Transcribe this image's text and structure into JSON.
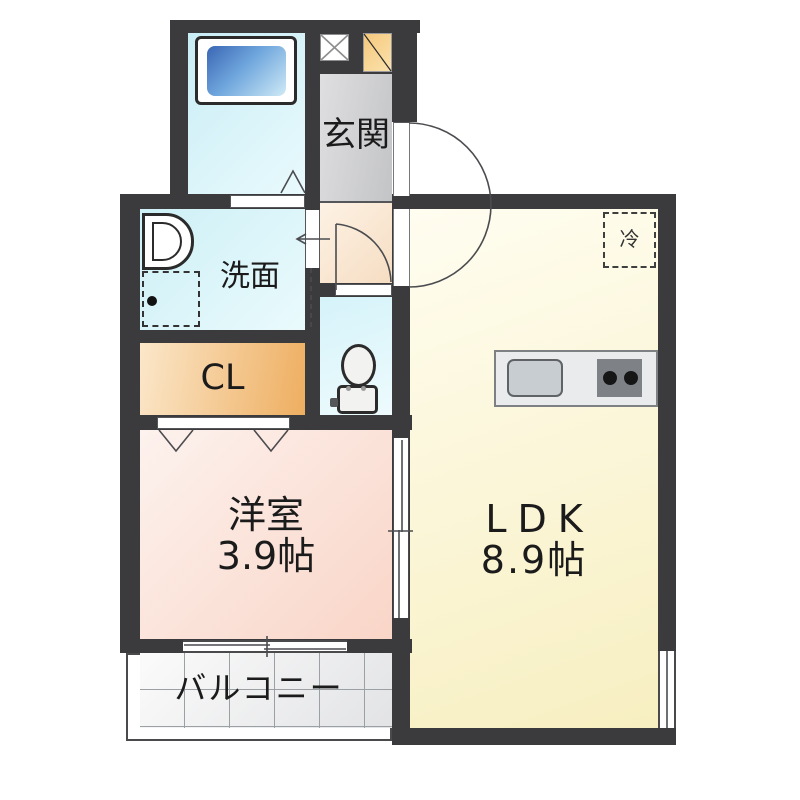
{
  "plan_type": "apartment-floor-plan",
  "rooms": {
    "entrance": {
      "label": "玄関"
    },
    "washroom": {
      "label": "洗面"
    },
    "closet": {
      "label": "CL"
    },
    "western_room": {
      "label": "洋室",
      "size": "3.9帖"
    },
    "ldk": {
      "label": "LDK",
      "size": "8.9帖"
    },
    "balcony": {
      "label": "バルコニー"
    },
    "bathroom": {
      "label": ""
    },
    "toilet": {
      "label": ""
    }
  },
  "fridge": {
    "label": "冷"
  },
  "fixtures": {
    "bathtub": "bathtub-icon",
    "washbasin": "washbasin-icon",
    "washing_machine": "washing-machine-space-icon",
    "toilet": "toilet-icon",
    "kitchen_sink": "kitchen-sink-icon",
    "stove": "stove-burners-icon",
    "refrigerator_space": "refrigerator-space",
    "pipe_shaft": "pipe-shaft-icon",
    "meter_box": "meter-box-icon"
  },
  "colors": {
    "wall": "#3b3b3d",
    "bathroom": "#cdeef6",
    "bathtub": "#3f6fb8",
    "washroom": "#d6f3f8",
    "toilet": "#dcf5fa",
    "closet": "#f0b264",
    "western_room": "#fad9cc",
    "ldk": "#f9f2c8",
    "entrance": "#c9cacc",
    "hallway": "#f8e3c9",
    "balcony_tile": "#ebebed",
    "kitchen_counter": "#e9ebec",
    "stove": "#7e8287",
    "meter_box": "#f5c87d"
  }
}
